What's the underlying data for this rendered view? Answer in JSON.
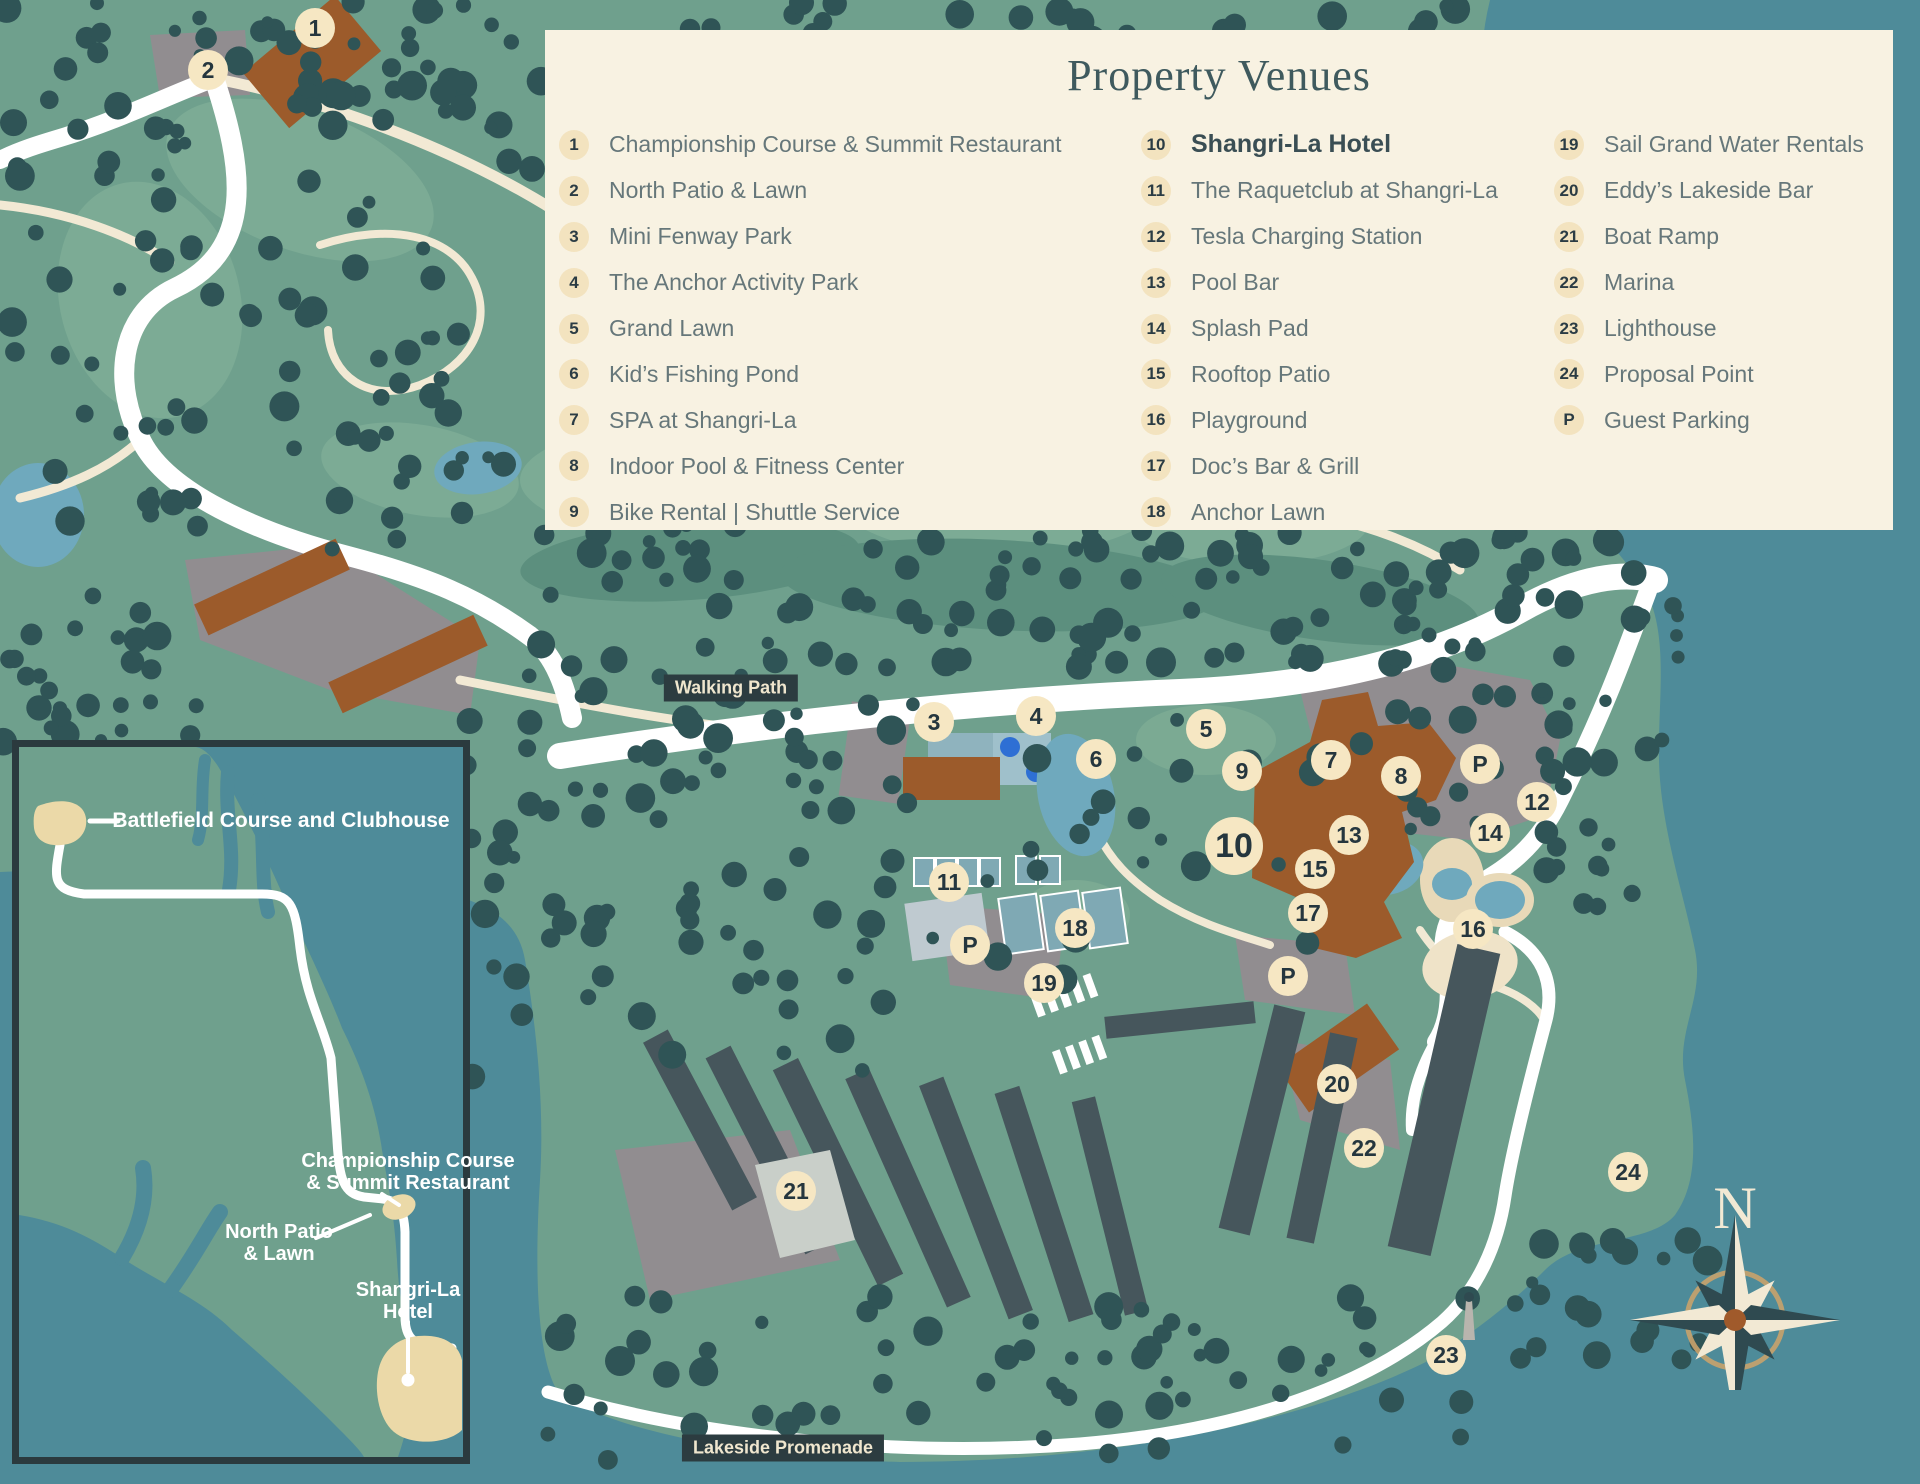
{
  "legend": {
    "title": "Property Venues",
    "columns": [
      [
        {
          "num": "1",
          "label": "Championship Course & Summit Restaurant"
        },
        {
          "num": "2",
          "label": "North Patio & Lawn"
        },
        {
          "num": "3",
          "label": "Mini Fenway Park"
        },
        {
          "num": "4",
          "label": "The Anchor Activity Park"
        },
        {
          "num": "5",
          "label": "Grand Lawn"
        },
        {
          "num": "6",
          "label": "Kid’s Fishing Pond"
        },
        {
          "num": "7",
          "label": "SPA at Shangri-La"
        },
        {
          "num": "8",
          "label": "Indoor Pool & Fitness Center"
        },
        {
          "num": "9",
          "label": "Bike Rental  |  Shuttle Service"
        }
      ],
      [
        {
          "num": "10",
          "label": "Shangri-La Hotel",
          "bold": true
        },
        {
          "num": "11",
          "label": "The Raquetclub at Shangri-La"
        },
        {
          "num": "12",
          "label": "Tesla Charging Station"
        },
        {
          "num": "13",
          "label": "Pool Bar"
        },
        {
          "num": "14",
          "label": "Splash Pad"
        },
        {
          "num": "15",
          "label": "Rooftop Patio"
        },
        {
          "num": "16",
          "label": "Playground"
        },
        {
          "num": "17",
          "label": "Doc’s Bar & Grill"
        },
        {
          "num": "18",
          "label": "Anchor Lawn"
        }
      ],
      [
        {
          "num": "19",
          "label": "Sail Grand Water Rentals"
        },
        {
          "num": "20",
          "label": "Eddy’s Lakeside Bar"
        },
        {
          "num": "21",
          "label": "Boat Ramp"
        },
        {
          "num": "22",
          "label": "Marina"
        },
        {
          "num": "23",
          "label": "Lighthouse"
        },
        {
          "num": "24",
          "label": "Proposal Point"
        },
        {
          "num": "P",
          "label": "Guest Parking"
        }
      ]
    ]
  },
  "map_labels": {
    "walking_path": "Walking Path",
    "lakeside_promenade": "Lakeside Promenade"
  },
  "inset": {
    "battlefield": "Battlefield Course and Clubhouse",
    "championship_line1": "Championship Course",
    "championship_line2": "& Summit Restaurant",
    "north_patio_line1": "North Patio",
    "north_patio_line2": "& Lawn",
    "hotel_line1": "Shangri-La",
    "hotel_line2": "Hotel"
  },
  "compass": {
    "north": "N"
  },
  "markers": [
    {
      "label": "1",
      "x": 315,
      "y": 28
    },
    {
      "label": "2",
      "x": 208,
      "y": 70
    },
    {
      "label": "3",
      "x": 934,
      "y": 722
    },
    {
      "label": "4",
      "x": 1036,
      "y": 716
    },
    {
      "label": "5",
      "x": 1206,
      "y": 729
    },
    {
      "label": "6",
      "x": 1096,
      "y": 759
    },
    {
      "label": "7",
      "x": 1331,
      "y": 760
    },
    {
      "label": "8",
      "x": 1401,
      "y": 776
    },
    {
      "label": "P",
      "x": 1480,
      "y": 764
    },
    {
      "label": "9",
      "x": 1242,
      "y": 771
    },
    {
      "label": "12",
      "x": 1537,
      "y": 802
    },
    {
      "label": "10",
      "x": 1234,
      "y": 846,
      "large": true
    },
    {
      "label": "13",
      "x": 1349,
      "y": 835
    },
    {
      "label": "14",
      "x": 1490,
      "y": 833
    },
    {
      "label": "15",
      "x": 1315,
      "y": 869
    },
    {
      "label": "17",
      "x": 1308,
      "y": 913
    },
    {
      "label": "16",
      "x": 1473,
      "y": 929
    },
    {
      "label": "11",
      "x": 949,
      "y": 882
    },
    {
      "label": "18",
      "x": 1075,
      "y": 928
    },
    {
      "label": "P",
      "x": 970,
      "y": 945
    },
    {
      "label": "19",
      "x": 1044,
      "y": 983
    },
    {
      "label": "P",
      "x": 1288,
      "y": 976
    },
    {
      "label": "20",
      "x": 1337,
      "y": 1084
    },
    {
      "label": "22",
      "x": 1364,
      "y": 1148
    },
    {
      "label": "21",
      "x": 796,
      "y": 1191
    },
    {
      "label": "24",
      "x": 1628,
      "y": 1172
    },
    {
      "label": "23",
      "x": 1446,
      "y": 1355
    }
  ],
  "colors": {
    "water": "#4E8B99",
    "land": "#6FA08D",
    "tree": "#2F5456",
    "fairway_light": "#7CAB95",
    "fairway_dark": "#5C8F7E",
    "road_cream": "#F2E9D4",
    "road_white": "#FFFFFF",
    "parking_gray": "#918D90",
    "building_brown": "#9C5B2B",
    "dock": "#46565C",
    "pond": "#6FA9BD",
    "splash_blue": "#2E6FD4",
    "legend_bg": "#F8F2E2",
    "badge_bg": "#F3E3BF",
    "badge_text": "#2B3C44",
    "legend_text": "#66777A",
    "title_text": "#3F5A5E",
    "label_badge_bg": "#2C3C40",
    "label_badge_text": "#EFE6CE",
    "inset_beige": "#EBD9A8",
    "compass_cream": "#F2E9D4",
    "compass_dark": "#2F4A50",
    "compass_center": "#A05A2B",
    "compass_ring": "#C9A26B"
  }
}
